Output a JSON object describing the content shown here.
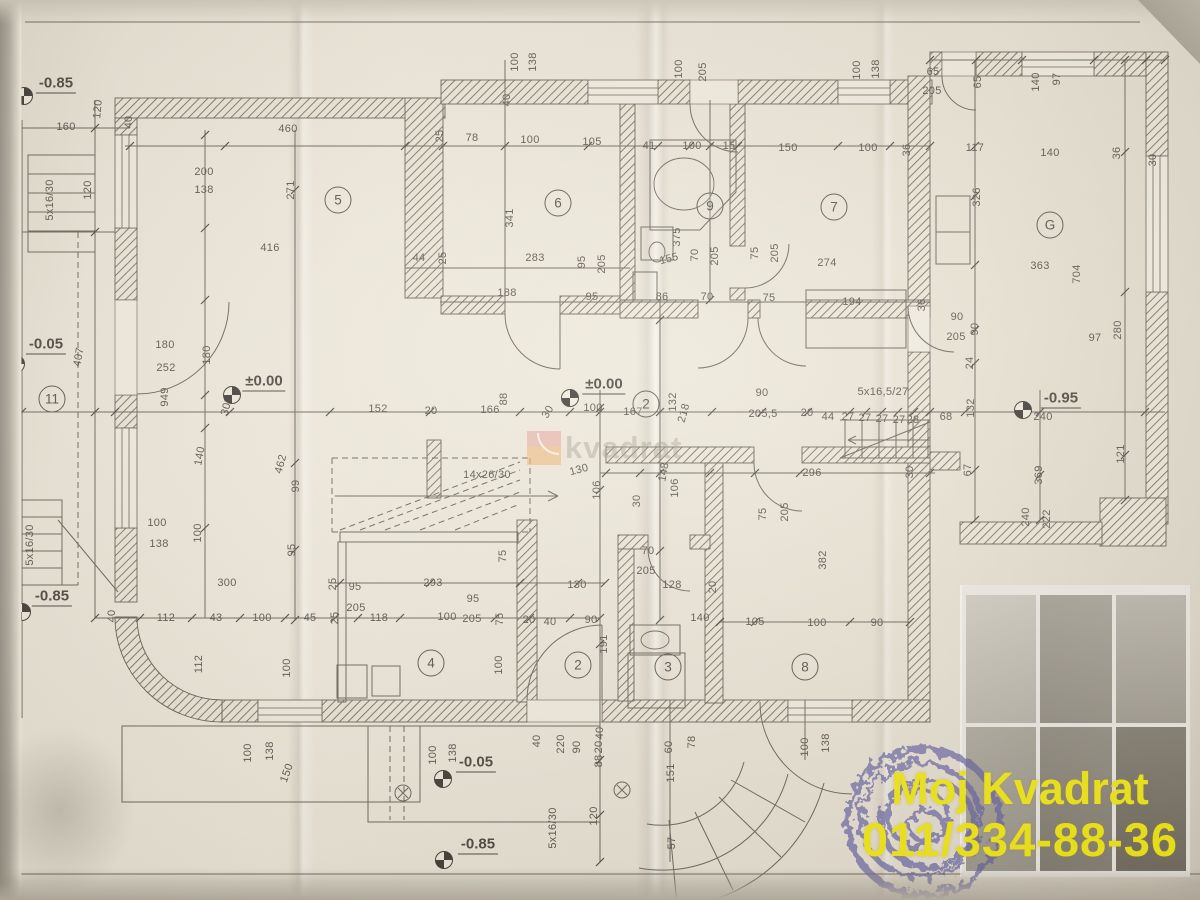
{
  "branding": {
    "name": "Moj Kvadrat",
    "phone": "011/334-88-36",
    "text_color": "#f4ec00"
  },
  "watermark": {
    "text": "kvadrat",
    "square_color": "#f0ad62",
    "accent_color": "#e89b94"
  },
  "elevations": [
    {
      "t": "-0.85",
      "mx": 24,
      "my": 96,
      "lx": 56,
      "ly": 84
    },
    {
      "t": "-0.05",
      "mx": 16,
      "my": 364,
      "lx": 46,
      "ly": 345
    },
    {
      "t": "±0.00",
      "mx": 232,
      "my": 395,
      "lx": 264,
      "ly": 382
    },
    {
      "t": "±0.00",
      "mx": 570,
      "my": 398,
      "lx": 604,
      "ly": 385
    },
    {
      "t": "-0.95",
      "mx": 1023,
      "my": 410,
      "lx": 1061,
      "ly": 399
    },
    {
      "t": "-0.85",
      "mx": 22,
      "my": 612,
      "lx": 52,
      "ly": 597
    },
    {
      "t": "-0.05",
      "mx": 443,
      "my": 779,
      "lx": 476,
      "ly": 763
    },
    {
      "t": "-0.85",
      "mx": 444,
      "my": 860,
      "lx": 478,
      "ly": 845
    }
  ],
  "rooms": [
    {
      "n": "5",
      "x": 338,
      "y": 200
    },
    {
      "n": "6",
      "x": 558,
      "y": 203
    },
    {
      "n": "9",
      "x": 710,
      "y": 206
    },
    {
      "n": "7",
      "x": 834,
      "y": 207
    },
    {
      "n": "G",
      "x": 1050,
      "y": 225
    },
    {
      "n": "11",
      "x": 52,
      "y": 399
    },
    {
      "n": "2",
      "x": 646,
      "y": 404
    },
    {
      "n": "4",
      "x": 431,
      "y": 663
    },
    {
      "n": "2",
      "x": 578,
      "y": 665
    },
    {
      "n": "3",
      "x": 668,
      "y": 667
    },
    {
      "n": "8",
      "x": 805,
      "y": 667
    }
  ],
  "dims": [
    [
      "10",
      7,
      125,
      -70
    ],
    [
      "160",
      66,
      127,
      0
    ],
    [
      "120",
      98,
      109,
      -85
    ],
    [
      "40",
      129,
      122,
      -90
    ],
    [
      "460",
      288,
      129,
      0
    ],
    [
      "200",
      204,
      172,
      0
    ],
    [
      "138",
      204,
      190,
      0
    ],
    [
      "271",
      291,
      190,
      -90
    ],
    [
      "5x16/30",
      50,
      200,
      -90
    ],
    [
      "120",
      88,
      190,
      -90
    ],
    [
      "416",
      270,
      248,
      0
    ],
    [
      "44",
      419,
      258,
      0
    ],
    [
      "25",
      443,
      258,
      -90
    ],
    [
      "78",
      472,
      138,
      0
    ],
    [
      "100",
      530,
      140,
      0
    ],
    [
      "105",
      592,
      142,
      0
    ],
    [
      "25",
      440,
      136,
      -90
    ],
    [
      "100",
      515,
      62,
      -90
    ],
    [
      "138",
      533,
      62,
      -90
    ],
    [
      "40",
      507,
      100,
      -90
    ],
    [
      "341",
      510,
      218,
      -90
    ],
    [
      "283",
      535,
      258,
      0
    ],
    [
      "95",
      582,
      262,
      -90
    ],
    [
      "205",
      602,
      264,
      -90
    ],
    [
      "188",
      507,
      293,
      0
    ],
    [
      "95",
      592,
      297,
      0
    ],
    [
      "86",
      662,
      297,
      0
    ],
    [
      "70",
      707,
      297,
      0
    ],
    [
      "75",
      769,
      298,
      0
    ],
    [
      "41",
      649,
      146,
      0
    ],
    [
      "100",
      692,
      146,
      0
    ],
    [
      "15",
      729,
      146,
      0
    ],
    [
      "100",
      679,
      69,
      -90
    ],
    [
      "205",
      703,
      72,
      -90
    ],
    [
      "150",
      788,
      148,
      0
    ],
    [
      "100",
      868,
      148,
      0
    ],
    [
      "36",
      907,
      150,
      -90
    ],
    [
      "100",
      857,
      70,
      -90
    ],
    [
      "138",
      876,
      69,
      -90
    ],
    [
      "375",
      677,
      237,
      -90
    ],
    [
      "155",
      669,
      259,
      -15
    ],
    [
      "70",
      695,
      255,
      -90
    ],
    [
      "205",
      715,
      256,
      -90
    ],
    [
      "75",
      755,
      253,
      -90
    ],
    [
      "205",
      775,
      253,
      -90
    ],
    [
      "274",
      827,
      263,
      0
    ],
    [
      "194",
      852,
      302,
      0
    ],
    [
      "90",
      957,
      317,
      0
    ],
    [
      "205",
      956,
      337,
      0
    ],
    [
      "90",
      975,
      329,
      -90
    ],
    [
      "24",
      970,
      363,
      -90
    ],
    [
      "36",
      922,
      305,
      -90
    ],
    [
      "65",
      933,
      72,
      0
    ],
    [
      "205",
      932,
      91,
      0
    ],
    [
      "65",
      978,
      82,
      -90
    ],
    [
      "140",
      1036,
      82,
      -90
    ],
    [
      "97",
      1057,
      79,
      -90
    ],
    [
      "117",
      975,
      148,
      0
    ],
    [
      "140",
      1050,
      153,
      0
    ],
    [
      "36",
      1117,
      153,
      -90
    ],
    [
      "30",
      1153,
      160,
      -90
    ],
    [
      "326",
      977,
      197,
      -90
    ],
    [
      "363",
      1040,
      266,
      0
    ],
    [
      "704",
      1077,
      274,
      -90
    ],
    [
      "97",
      1095,
      338,
      0
    ],
    [
      "280",
      1118,
      330,
      -90
    ],
    [
      "5x16,5/27",
      883,
      392,
      0
    ],
    [
      "90",
      762,
      393,
      0
    ],
    [
      "205,5",
      763,
      414,
      0
    ],
    [
      "20",
      807,
      413,
      0
    ],
    [
      "44",
      828,
      417,
      0
    ],
    [
      "27",
      848,
      417,
      0
    ],
    [
      "27",
      865,
      418,
      0
    ],
    [
      "27",
      882,
      419,
      0
    ],
    [
      "27",
      899,
      420,
      0
    ],
    [
      "28",
      913,
      420,
      0
    ],
    [
      "68",
      946,
      417,
      0
    ],
    [
      "132",
      971,
      408,
      -90
    ],
    [
      "240",
      1043,
      417,
      0
    ],
    [
      "121",
      1121,
      454,
      -90
    ],
    [
      "369",
      1039,
      475,
      -90
    ],
    [
      "67",
      968,
      470,
      -90
    ],
    [
      "240",
      1026,
      517,
      -90
    ],
    [
      "222",
      1047,
      519,
      -90
    ],
    [
      "407",
      79,
      357,
      -80
    ],
    [
      "180",
      165,
      345,
      0
    ],
    [
      "252",
      166,
      368,
      0
    ],
    [
      "949",
      165,
      397,
      -90
    ],
    [
      "180",
      207,
      355,
      -90
    ],
    [
      "300",
      227,
      406,
      -75
    ],
    [
      "152",
      378,
      409,
      0
    ],
    [
      "20",
      431,
      411,
      0
    ],
    [
      "166",
      490,
      410,
      0
    ],
    [
      "88",
      504,
      399,
      -90
    ],
    [
      "30",
      548,
      412,
      -60
    ],
    [
      "100",
      593,
      408,
      0
    ],
    [
      "167",
      633,
      412,
      0
    ],
    [
      "132",
      673,
      402,
      -90
    ],
    [
      "218",
      684,
      413,
      -75
    ],
    [
      "462",
      281,
      464,
      -75
    ],
    [
      "99",
      296,
      486,
      -90
    ],
    [
      "140",
      200,
      456,
      -80
    ],
    [
      "14x26/30",
      487,
      475,
      0
    ],
    [
      "130",
      579,
      470,
      -15
    ],
    [
      "148",
      664,
      472,
      -80
    ],
    [
      "106",
      597,
      490,
      -90
    ],
    [
      "106",
      675,
      488,
      -90
    ],
    [
      "30",
      637,
      501,
      -90
    ],
    [
      "296",
      812,
      473,
      0
    ],
    [
      "75",
      763,
      514,
      -90
    ],
    [
      "205",
      785,
      512,
      -90
    ],
    [
      "382",
      823,
      560,
      -90
    ],
    [
      "30",
      910,
      472,
      -90
    ],
    [
      "100",
      157,
      523,
      0
    ],
    [
      "138",
      159,
      544,
      0
    ],
    [
      "100",
      198,
      533,
      -90
    ],
    [
      "95",
      292,
      550,
      -90
    ],
    [
      "300",
      227,
      583,
      0
    ],
    [
      "40",
      112,
      616,
      -90
    ],
    [
      "112",
      166,
      618,
      0
    ],
    [
      "43",
      216,
      618,
      0
    ],
    [
      "100",
      262,
      618,
      0
    ],
    [
      "45",
      310,
      618,
      0
    ],
    [
      "25",
      335,
      618,
      -90
    ],
    [
      "95",
      355,
      587,
      0
    ],
    [
      "205",
      356,
      608,
      0
    ],
    [
      "118",
      379,
      618,
      0
    ],
    [
      "25",
      333,
      584,
      -90
    ],
    [
      "75",
      503,
      556,
      -90
    ],
    [
      "293",
      433,
      583,
      0
    ],
    [
      "95",
      473,
      599,
      0
    ],
    [
      "205",
      472,
      619,
      0
    ],
    [
      "100",
      447,
      617,
      0
    ],
    [
      "75",
      500,
      619,
      -90
    ],
    [
      "20",
      529,
      620,
      0
    ],
    [
      "40",
      550,
      622,
      0
    ],
    [
      "130",
      577,
      585,
      0
    ],
    [
      "90",
      591,
      620,
      0
    ],
    [
      "70",
      648,
      551,
      0
    ],
    [
      "205",
      646,
      571,
      0
    ],
    [
      "128",
      672,
      585,
      0
    ],
    [
      "20",
      713,
      587,
      -90
    ],
    [
      "140",
      700,
      618,
      0
    ],
    [
      "191",
      604,
      644,
      -90
    ],
    [
      "100",
      499,
      665,
      -90
    ],
    [
      "105",
      755,
      622,
      0
    ],
    [
      "100",
      817,
      623,
      0
    ],
    [
      "90",
      877,
      623,
      0
    ],
    [
      "5x16/30",
      553,
      828,
      -90
    ],
    [
      "120",
      594,
      816,
      -90
    ],
    [
      "40",
      537,
      741,
      -90
    ],
    [
      "220",
      561,
      744,
      -90
    ],
    [
      "90",
      577,
      747,
      -90
    ],
    [
      "88",
      599,
      761,
      -90
    ],
    [
      "20",
      599,
      747,
      -90
    ],
    [
      "40",
      600,
      733,
      -90
    ],
    [
      "60",
      669,
      747,
      -90
    ],
    [
      "78",
      692,
      742,
      -90
    ],
    [
      "151",
      671,
      773,
      -90
    ],
    [
      "57",
      672,
      843,
      -90
    ],
    [
      "100",
      805,
      747,
      -90
    ],
    [
      "138",
      826,
      743,
      -90
    ],
    [
      "100",
      433,
      755,
      -90
    ],
    [
      "138",
      453,
      753,
      -90
    ],
    [
      "100",
      248,
      753,
      -90
    ],
    [
      "138",
      270,
      751,
      -90
    ],
    [
      "112",
      199,
      664,
      -90
    ],
    [
      "150",
      287,
      773,
      -70
    ],
    [
      "100",
      287,
      668,
      -90
    ],
    [
      "5x16/30",
      30,
      545,
      -90
    ]
  ]
}
